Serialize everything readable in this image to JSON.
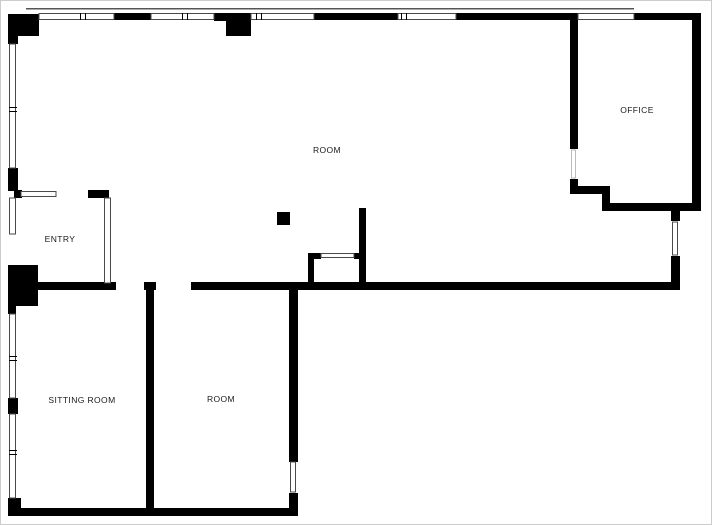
{
  "plan": {
    "rooms": [
      {
        "id": "main-room",
        "label": "ROOM"
      },
      {
        "id": "office",
        "label": "OFFICE"
      },
      {
        "id": "entry",
        "label": "ENTRY"
      },
      {
        "id": "sitting-room",
        "label": "SITTING ROOM"
      },
      {
        "id": "bottom-room",
        "label": "ROOM"
      }
    ],
    "colors": {
      "wall": "#000000",
      "background": "#ffffff",
      "frame_border": "#cccccc",
      "window_outline": "#4a4a4a",
      "label_text": "#1a1a1a"
    }
  }
}
